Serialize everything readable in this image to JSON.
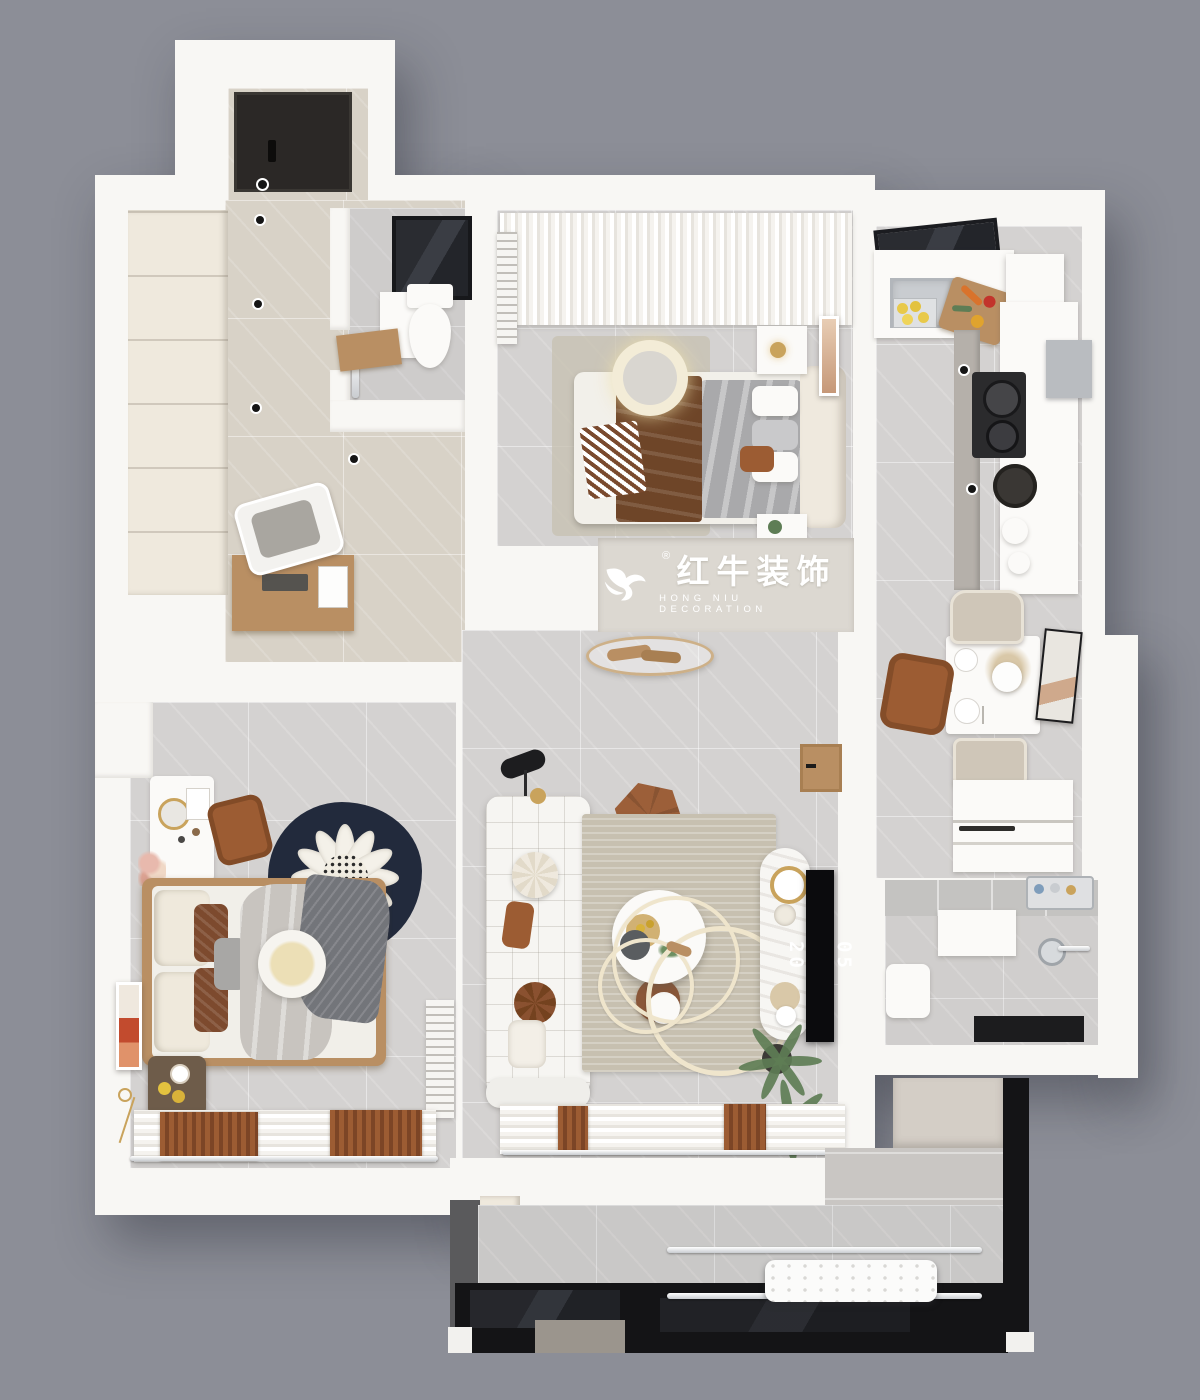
{
  "canvas": {
    "width": 1200,
    "height": 1400
  },
  "palette": {
    "background": "#8C8E97",
    "wall": "#F8F7F4",
    "wall-shadow": "#E7E4DE",
    "floor-gray": "#D4D2D1",
    "floor-warm": "#D8D2C7",
    "wood": "#B98F63",
    "wood-dark": "#6E5C4A",
    "door-dark": "#2B2826",
    "frame-black": "#141416",
    "counter-white": "#FBFAF8",
    "steel": "#C9CCD0",
    "brown-leather": "#9C5C33",
    "brown-blanket": "#6E4528",
    "textile-gray": "#A9A9AB",
    "rug-beige": "#C7C0B0",
    "rug-navy": "#222A3C",
    "cream": "#EFE9DD",
    "green": "#5E7D55",
    "gold": "#C9A35C",
    "watermark-band": "#DCD8D1",
    "tv-black": "#0B0B0D"
  },
  "watermark": {
    "registered": "®",
    "brand_zh": "红牛装饰",
    "brand_en": "HONG NIU DECORATION"
  },
  "tv": {
    "clock_top": "05",
    "clock_bottom": "20"
  }
}
